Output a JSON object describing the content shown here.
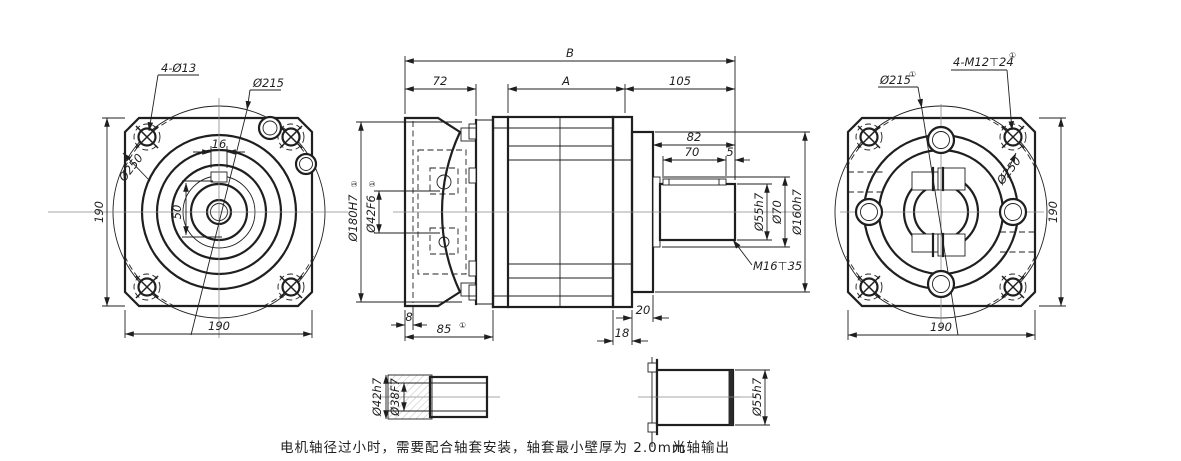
{
  "views": {
    "input_flange_view": {
      "label_corner_holes": "4-Ø13",
      "label_housing_dia": "Ø215",
      "label_bolt_circle": "Ø250",
      "dim_keyway_width": "16",
      "dim_keyway_to_center": "50",
      "dim_flange_height": "190",
      "dim_flange_width": "190"
    },
    "side_view": {
      "dim_overall_length": "B",
      "dim_adapter_length": "72",
      "dim_body_length": "A",
      "dim_output_length": "105",
      "dim_shaft_length": "82",
      "dim_key_length": "70",
      "dim_key_end_gap": "5",
      "dim_shaft_dia": "Ø55h7",
      "dim_shoulder_dia": "Ø70",
      "dim_pilot_dia": "Ø160h7",
      "dim_motor_pilot_dia": "Ø180H7",
      "sup_motor_pilot": "①",
      "dim_motor_shaft_bore": "Ø42F6",
      "sup_motor_shaft_bore": "①",
      "label_end_tap": "M16⊤35",
      "dim_plate_thickness": "8",
      "dim_adapter_depth": "85",
      "sup_adapter_depth": "①",
      "dim_flange_plate": "18",
      "dim_output_pilot_len": "20"
    },
    "output_flange_view": {
      "label_housing_dia": "Ø215",
      "sup_housing_dia": "①",
      "label_tapped_holes": "4-M12⊤24",
      "sup_tapped_holes": "①",
      "label_bolt_circle": "Ø250",
      "dim_flange_height": "190",
      "dim_flange_width": "190"
    },
    "bushing_detail": {
      "dim_outer_dia": "Ø42h7",
      "dim_bore_dia": "Ø38F7"
    },
    "plain_shaft_detail": {
      "dim_shaft_dia": "Ø55h7",
      "caption": "光轴输出"
    },
    "notes": {
      "bushing_note": "电机轴径过小时，需要配合轴套安装，轴套最小壁厚为 2.0mm"
    }
  }
}
